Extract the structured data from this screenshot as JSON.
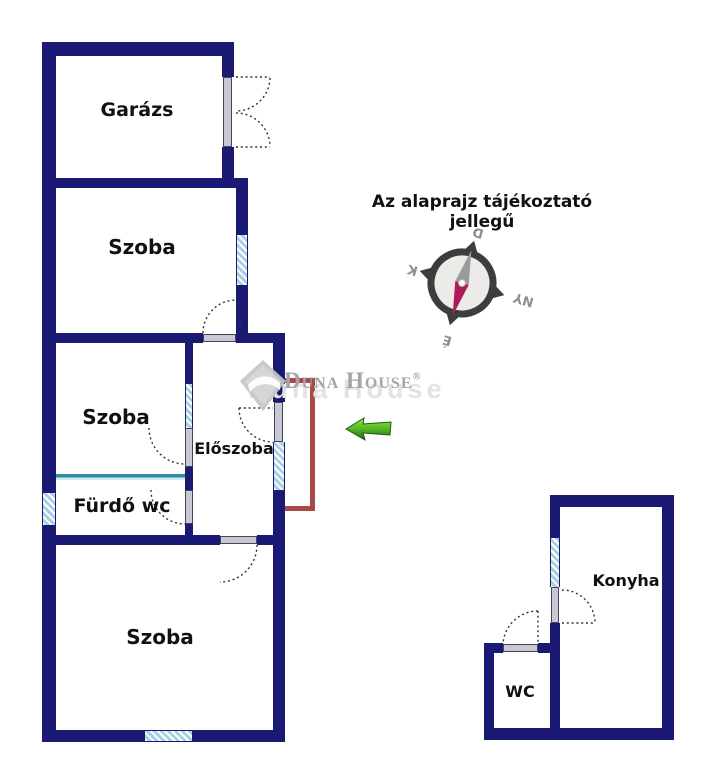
{
  "title": "Az alaprajz tájékoztató jellegű",
  "rooms": {
    "garage": "Garázs",
    "room1": "Szoba",
    "room2": "Szoba",
    "hall": "Előszoba",
    "bathroom": "Fürdő wc",
    "room3": "Szoba",
    "kitchen": "Konyha",
    "wc": "WC"
  },
  "compass": {
    "north": "É",
    "south": "D",
    "east": "K",
    "west": "NY"
  },
  "watermark": {
    "text": "Duna House",
    "reg": "®"
  },
  "colors": {
    "wall": "#1a1a74",
    "window_hatch": "#a9cfe3",
    "door_leaf": "#c9c9d6",
    "teal_divider": "#2e8fa2",
    "red_marker": "#a84b48",
    "arrow_green": "#3d9a1c",
    "watermark_gray": "#a5a5a5"
  }
}
